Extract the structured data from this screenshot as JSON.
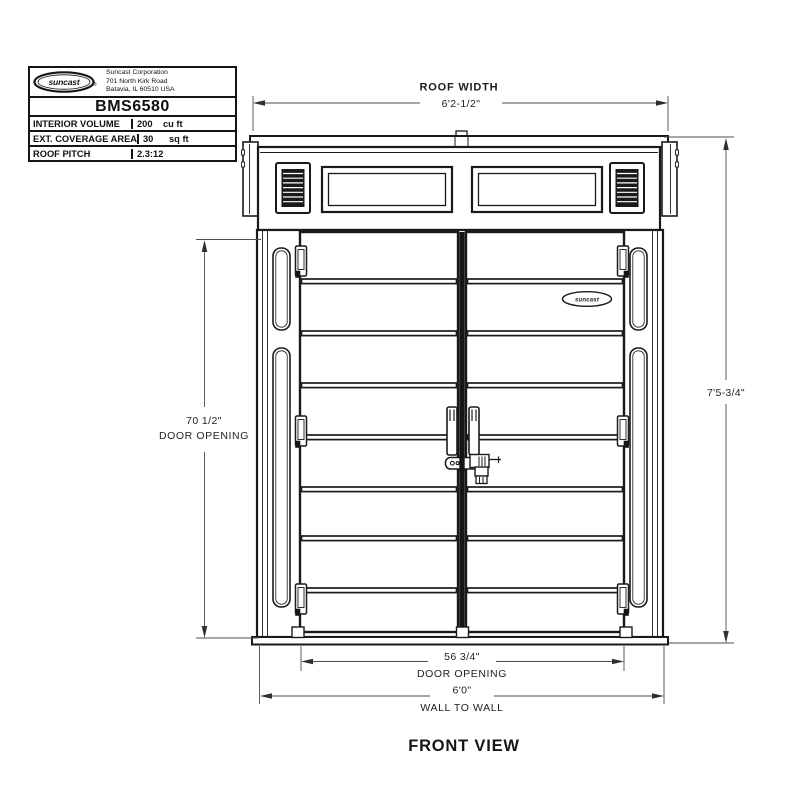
{
  "title_block": {
    "logo_text": "suncast",
    "logo_reg": "®",
    "company_lines": [
      "Suncast Corporation",
      "701 North Kirk Road",
      "Batavia, IL 60510 USA"
    ],
    "model": "BMS6580",
    "specs": [
      {
        "label": "INTERIOR VOLUME",
        "value": "200",
        "unit": "cu ft"
      },
      {
        "label": "EXT. COVERAGE AREA",
        "value": "30",
        "unit": "sq ft"
      },
      {
        "label": "ROOF PITCH",
        "value": "2.3:12",
        "unit": ""
      }
    ]
  },
  "drawing": {
    "roof_width": {
      "label": "ROOF WIDTH",
      "value": "6'2-1/2\""
    },
    "overall_height": {
      "value": "7'5-3/4\""
    },
    "door_opening_height": {
      "value": "70 1/2\"",
      "label": "DOOR OPENING"
    },
    "door_opening_width": {
      "value": "56 3/4\"",
      "label": "DOOR OPENING"
    },
    "wall_to_wall": {
      "value": "6'0\"",
      "label": "WALL TO WALL"
    },
    "door_logo_text": "suncast",
    "view_label": "FRONT VIEW"
  },
  "colors": {
    "line": "#1a1a1a",
    "dim_line": "#4d4d4d",
    "text": "#222222",
    "background": "#ffffff"
  }
}
